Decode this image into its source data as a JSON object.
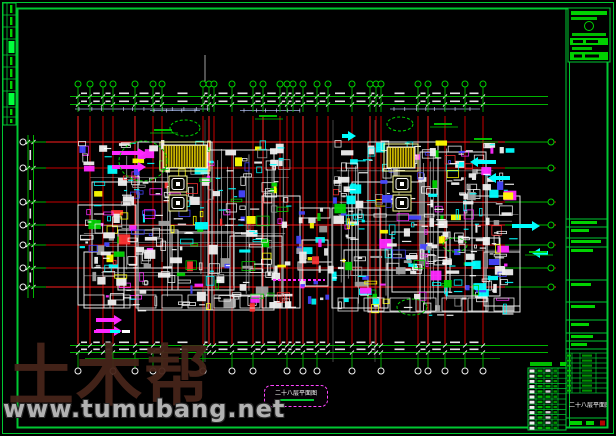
{
  "sheet": {
    "background": "#000000",
    "frame_color": "#00c832",
    "grid_red": "#c80000",
    "grid_red_bright": "#ff1e1e",
    "dim_green": "#00b400",
    "bubble_green": "#00d200",
    "white": "#f0f0f0",
    "palette": [
      "#f0f0f0",
      "#00ffff",
      "#ff28ff",
      "#ffff00",
      "#4646ff",
      "#ff3232",
      "#00d200",
      "#a0a0a0"
    ]
  },
  "watermark": {
    "brand": "土木帮",
    "url": "www.tumubang.net"
  },
  "plan": {
    "floor_label": "二十八层平面图",
    "grid_x": [
      78,
      90,
      103,
      113,
      135,
      153,
      162,
      203,
      209,
      214,
      232,
      253,
      263,
      280,
      287,
      293,
      303,
      317,
      328,
      352,
      370,
      376,
      381,
      418,
      428,
      445,
      465,
      483
    ],
    "grid_y": [
      142,
      168,
      202,
      225,
      245,
      268,
      287
    ],
    "bottom_bubble_x": [
      78,
      113,
      135,
      153,
      162,
      203,
      232,
      253,
      287,
      303,
      317,
      352,
      381,
      418,
      428,
      445,
      465,
      483
    ]
  },
  "title_block": {
    "drawing_title": "二十八层平面图"
  }
}
